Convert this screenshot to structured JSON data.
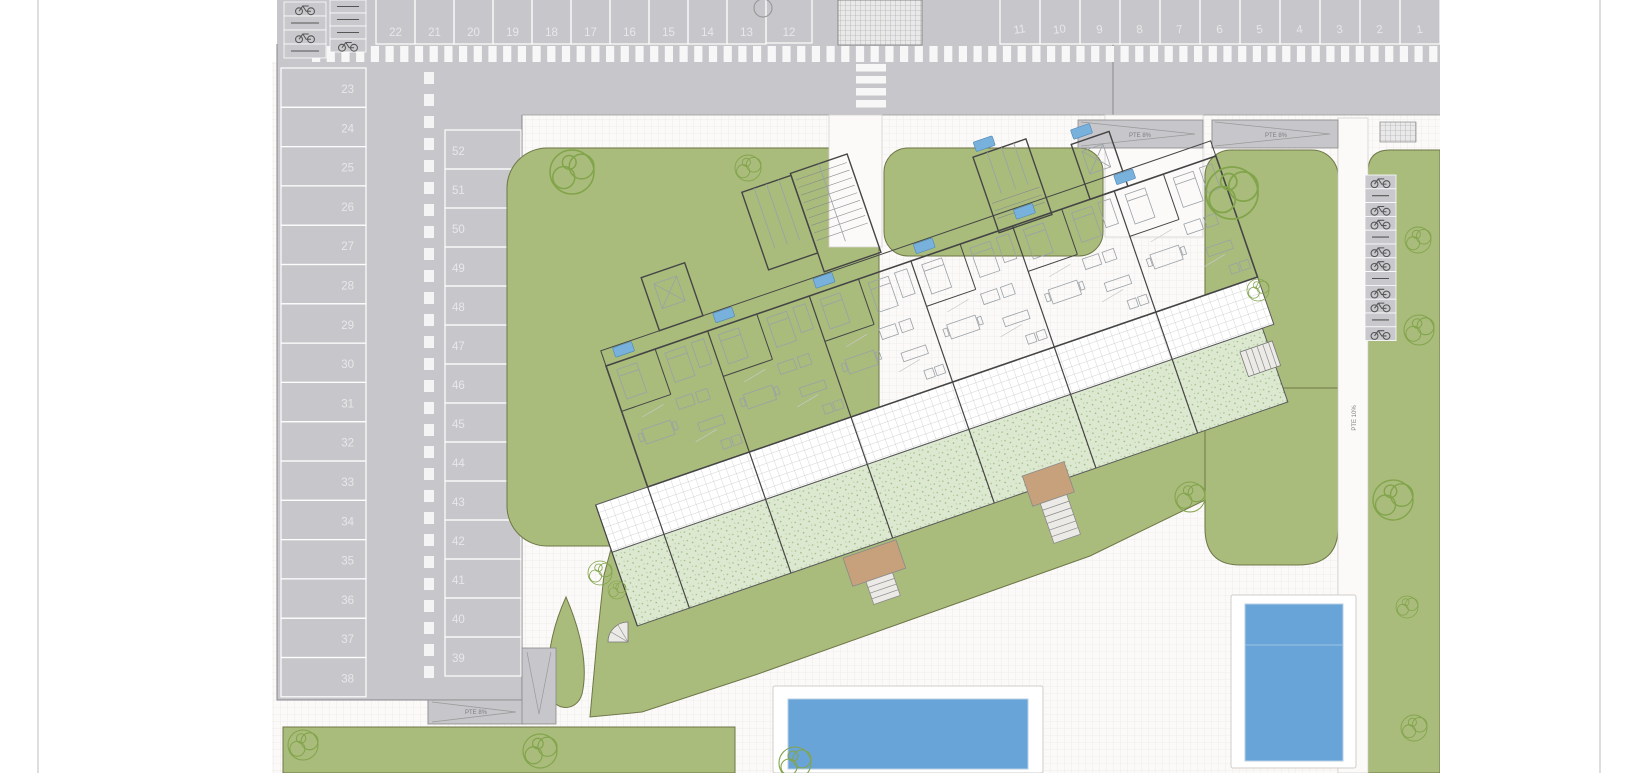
{
  "parking": {
    "top_row_left": [
      "22",
      "21",
      "20",
      "19",
      "18",
      "17",
      "16",
      "15",
      "14",
      "13"
    ],
    "top_row_single": "12",
    "top_row_right": [
      "11",
      "10",
      "9",
      "8",
      "7",
      "6",
      "5",
      "4",
      "3",
      "2",
      "1"
    ],
    "left_column": [
      "23",
      "24",
      "25",
      "26",
      "27",
      "28",
      "29",
      "30",
      "31",
      "32",
      "33",
      "34",
      "35",
      "36",
      "37",
      "38"
    ],
    "right_column": [
      "52",
      "51",
      "50",
      "49",
      "48",
      "47",
      "46",
      "45",
      "44",
      "43",
      "42",
      "41",
      "40",
      "39"
    ]
  },
  "labels": {
    "ramp_top_1": "PTE 8%",
    "ramp_top_2": "PTE 8%",
    "ramp_bottom": "PTE 8%",
    "ramp_side": "PTE 10%"
  },
  "colors": {
    "road": "#c7c7cb",
    "lawn": "#a9bc7c",
    "pool_water": "#68a4d8",
    "garden_plot": "#dce9d0",
    "unit_tag": "#79b1dd",
    "wood_deck": "#c7a17b",
    "building_wall": "#454545",
    "tree": "#82a44b"
  }
}
